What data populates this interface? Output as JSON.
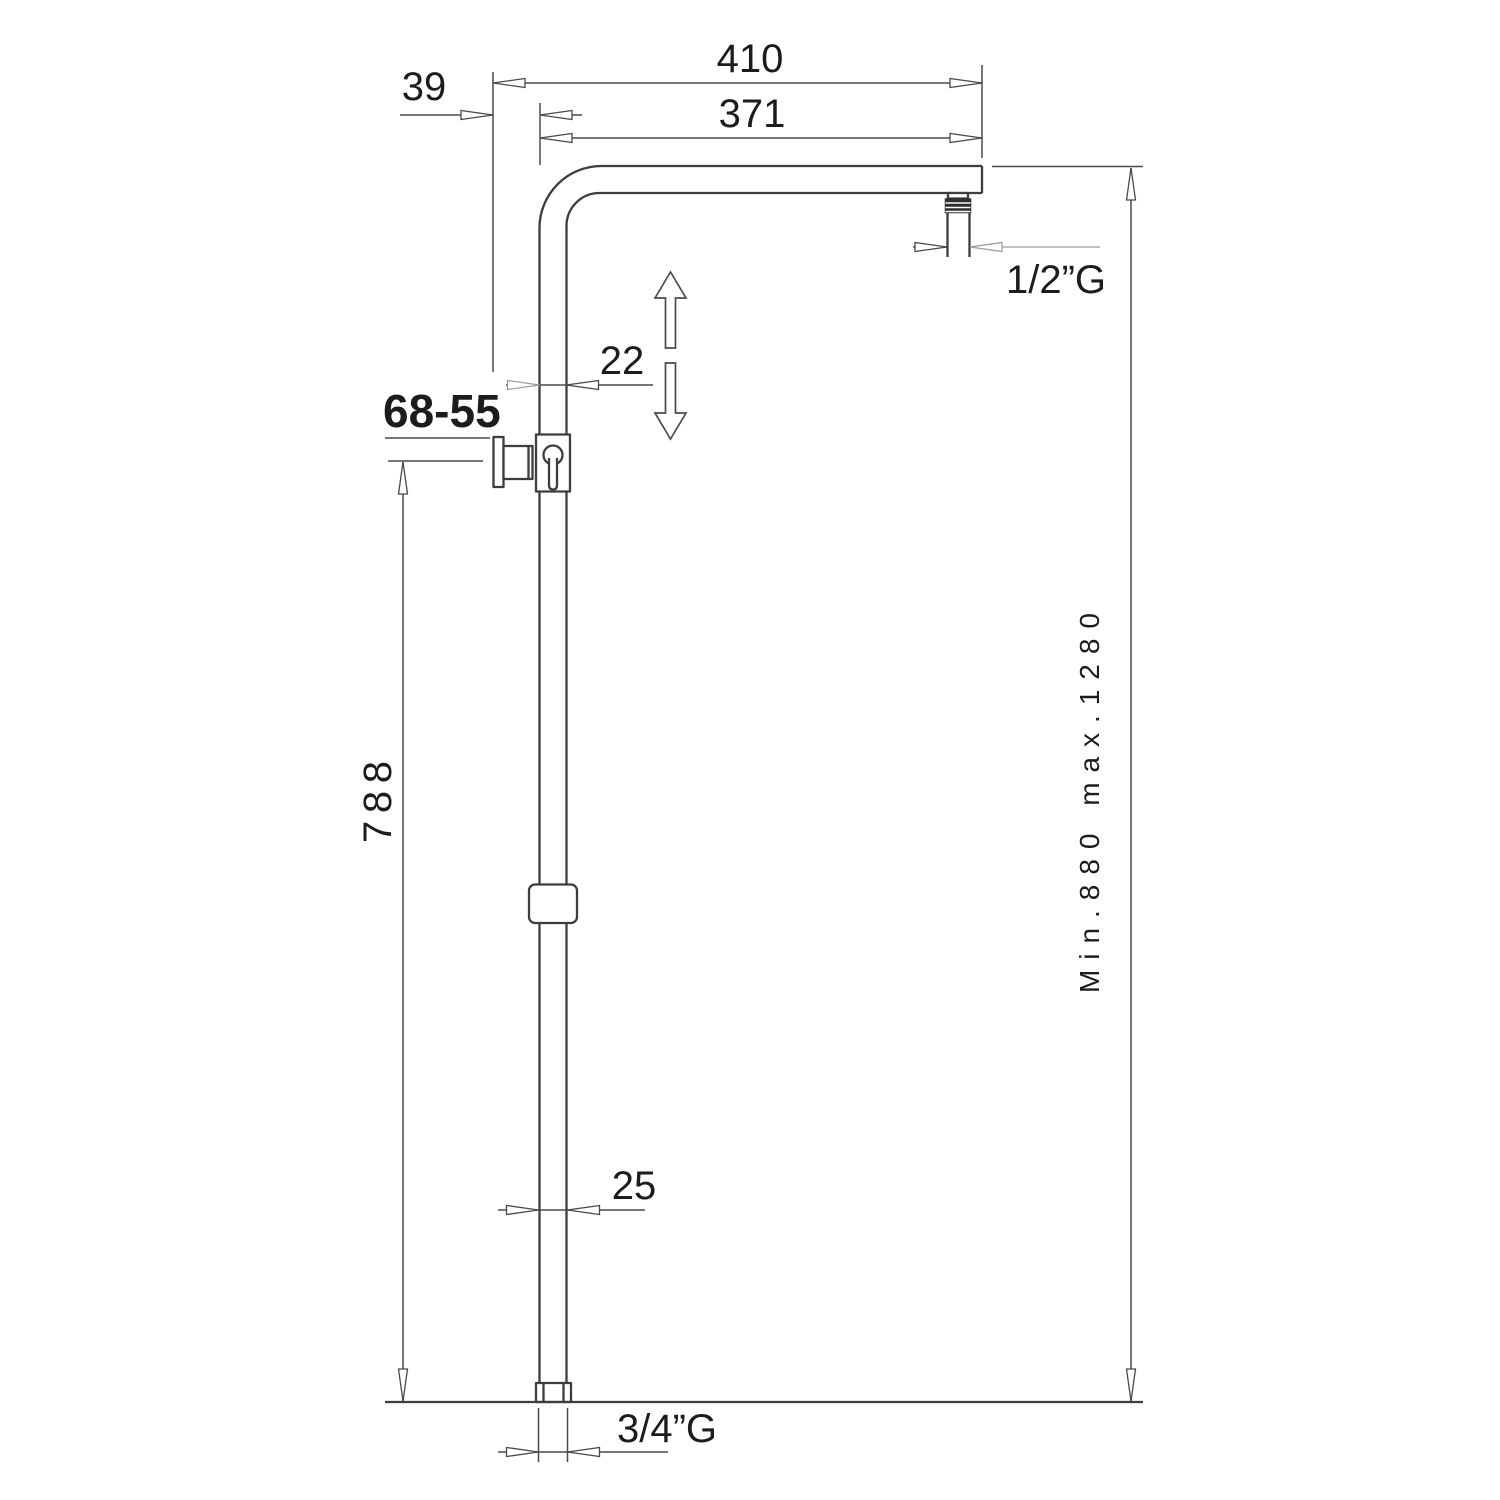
{
  "drawing": {
    "description": "shower column dimensional drawing",
    "dims": {
      "top_width": "410",
      "wall_offset": "39",
      "arm_reach": "371",
      "thread_top": "1/2”G",
      "pipe_width_upper": "22",
      "model_code": "68-55",
      "riser_height": "788",
      "pipe_width_lower": "25",
      "thread_bottom": "3/4”G",
      "height_range": "Min.880 max.1280"
    },
    "colors": {
      "background": "#ffffff",
      "outline": "#3d3d3d",
      "dimension_line": "#4a4a4a",
      "light_line": "#9a9a9a",
      "text": "#1c1c1c"
    }
  }
}
